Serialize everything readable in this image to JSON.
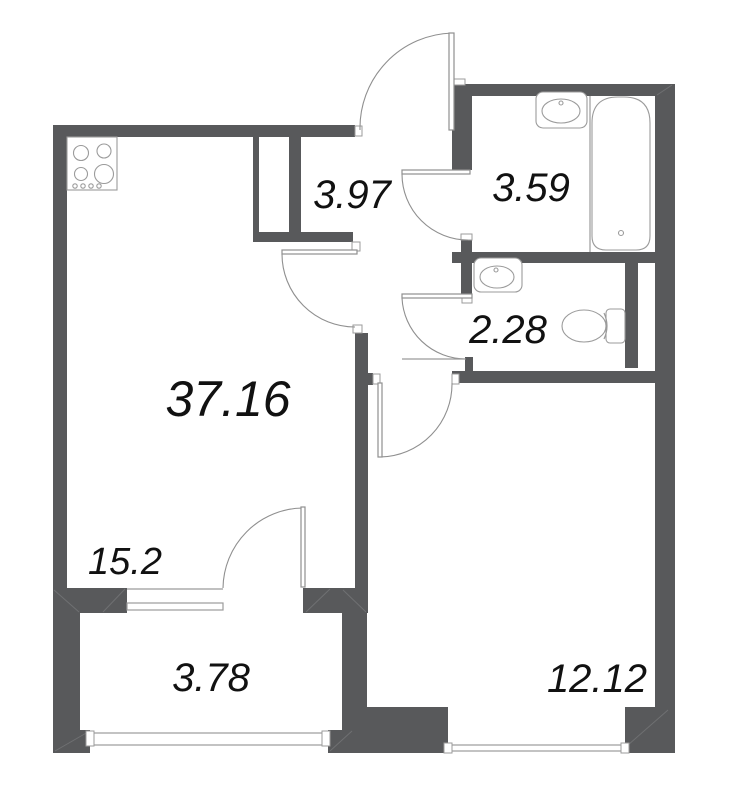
{
  "title": "apartment-floor-plan",
  "labels": {
    "total_area": "37.16",
    "hallway_area": "3.97",
    "bathroom_area": "3.59",
    "toilet_area": "2.28",
    "kitchen_living_area": "15.2",
    "balcony_area": "3.78",
    "bedroom_area": "12.12"
  },
  "rooms": [
    {
      "name": "kitchen-living-room",
      "area": "15.2"
    },
    {
      "name": "hallway",
      "area": "3.97"
    },
    {
      "name": "bathroom",
      "area": "3.59"
    },
    {
      "name": "toilet-room",
      "area": "2.28"
    },
    {
      "name": "bedroom",
      "area": "12.12"
    },
    {
      "name": "balcony",
      "area": "3.78"
    }
  ],
  "fixtures": [
    "stove-icon",
    "bathroom-sink-icon",
    "bathtub-icon",
    "toilet-sink-icon",
    "toilet-icon"
  ],
  "colors": {
    "wall": "#58595b",
    "fixture-line": "#9b9b9b",
    "door-line": "#8f8f8f",
    "text": "#111111",
    "bg": "#ffffff"
  }
}
